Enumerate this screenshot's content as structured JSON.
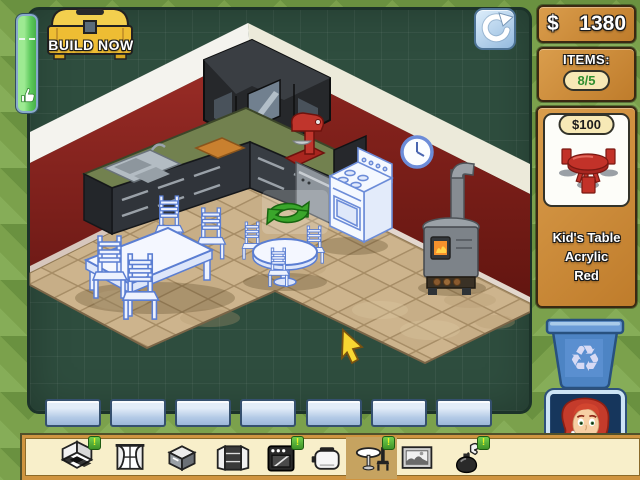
{
  "hud": {
    "build_button_label": "BUILD NOW",
    "money": {
      "currency_symbol": "$",
      "amount": "1380"
    },
    "items_counter": {
      "label": "ITEMS:",
      "value": "8/5"
    },
    "progress_bar": {
      "icon": "thumbs-up-icon"
    },
    "rotate_button_icon": "rotate-arrow-icon"
  },
  "shop_card": {
    "price": "$100",
    "item_name": "Kid's Table",
    "material": "Acrylic",
    "color_name": "Red",
    "preview_icon": "kids-table-red-preview"
  },
  "toolbar": {
    "badge_char": "!",
    "selected_index": 6,
    "items": [
      {
        "icon": "floor-room-icon",
        "badge": true
      },
      {
        "icon": "curtains-icon",
        "badge": false
      },
      {
        "icon": "kitchen-island-icon",
        "badge": false
      },
      {
        "icon": "cabinet-icon",
        "badge": false
      },
      {
        "icon": "oven-icon",
        "badge": true
      },
      {
        "icon": "toaster-icon",
        "badge": false
      },
      {
        "icon": "table-chair-icon",
        "badge": true,
        "selected": true
      },
      {
        "icon": "picture-icon",
        "badge": false
      },
      {
        "icon": "vase-icon",
        "badge": true
      }
    ]
  },
  "room": {
    "objects": [
      "corner-wall-cabinet",
      "kitchen-counter",
      "sink",
      "cutting-board",
      "red-mixer",
      "dishwasher",
      "blueprint-stove",
      "wood-stove",
      "wall-clock",
      "blueprint-dining-table",
      "blueprint-chairs",
      "blueprint-kids-round-table",
      "rotate-arrows-marker",
      "wall-tiles",
      "yellow-cursor"
    ]
  },
  "colors": {
    "wall_red": "#8a2420",
    "floor_tan": "#c7ae87",
    "counter_green": "#72814f",
    "blueprint_blue": "#5b7ed2",
    "panel_green": "#2e4d3e",
    "hud_orange": "#cf8a3a",
    "tile_blue": "#b2c9e6",
    "badge_green": "#4fae36",
    "bin_blue": "#4d84c4"
  }
}
